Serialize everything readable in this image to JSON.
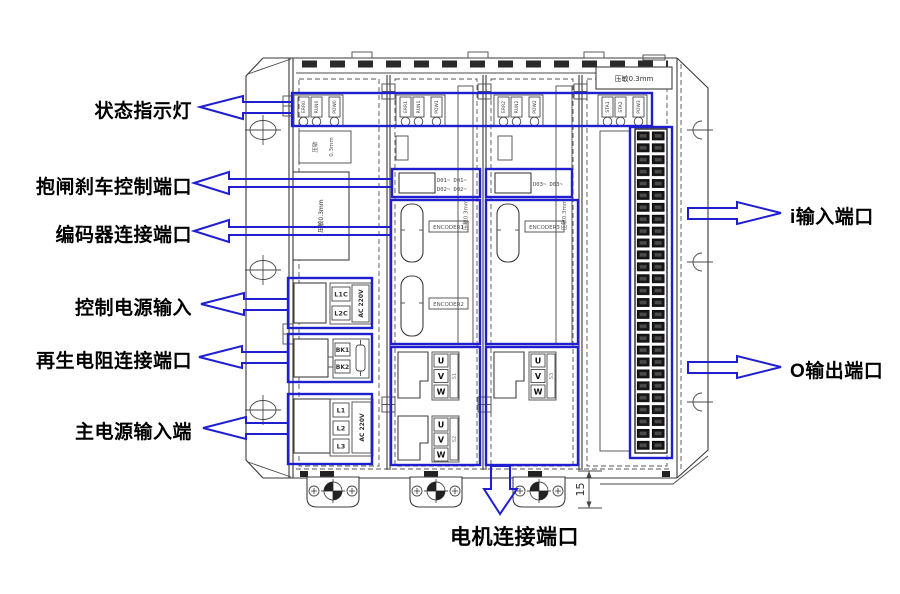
{
  "colors": {
    "accent_blue": "#1f1fd0",
    "line_gray": "#3a3a3a"
  },
  "callouts": {
    "status_leds": "状态指示灯",
    "brake_port": "抱闸刹车控制端口",
    "encoder_port": "编码器连接端口",
    "control_power": "控制电源输入",
    "regen_resistor": "再生电阻连接端口",
    "main_power": "主电源输入端",
    "input_port": "i输入端口",
    "output_port": "O输出端口",
    "motor_port": "电机连接端口"
  },
  "device": {
    "varistor": "压敏0.3mm",
    "varistor_small": {
      "a": "压敏",
      "b": "0.3mm"
    },
    "foot_height_dim": "15",
    "panels": [
      {
        "leds": [
          "ERR0",
          "RUN0",
          "POW0"
        ]
      },
      {
        "leds": [
          "ERR1",
          "RUN1",
          "POW1"
        ]
      },
      {
        "leds": [
          "ERR2",
          "RUN2",
          "POW2"
        ]
      },
      {
        "leds": [
          "STA1",
          "STA2",
          "POW3"
        ]
      }
    ],
    "brake": {
      "d01": "D01~ D01~",
      "d02": "D02~ D02~",
      "d03": "D03~ D03~"
    },
    "encoders": [
      "ENCODER1",
      "ENCODER2",
      "ENCODER3"
    ],
    "motor_terminals": {
      "u": "U",
      "v": "V",
      "w": "W",
      "s1": "S1",
      "s2": "S2",
      "s3": "S3"
    },
    "power": {
      "ctrl": {
        "t1": "L1C",
        "t2": "L2C",
        "v": "AC 220V"
      },
      "bk": {
        "t1": "BK1",
        "t2": "BK2"
      },
      "main": {
        "t1": "L1",
        "t2": "L2",
        "t3": "L3",
        "v": "AC 220V"
      }
    }
  }
}
